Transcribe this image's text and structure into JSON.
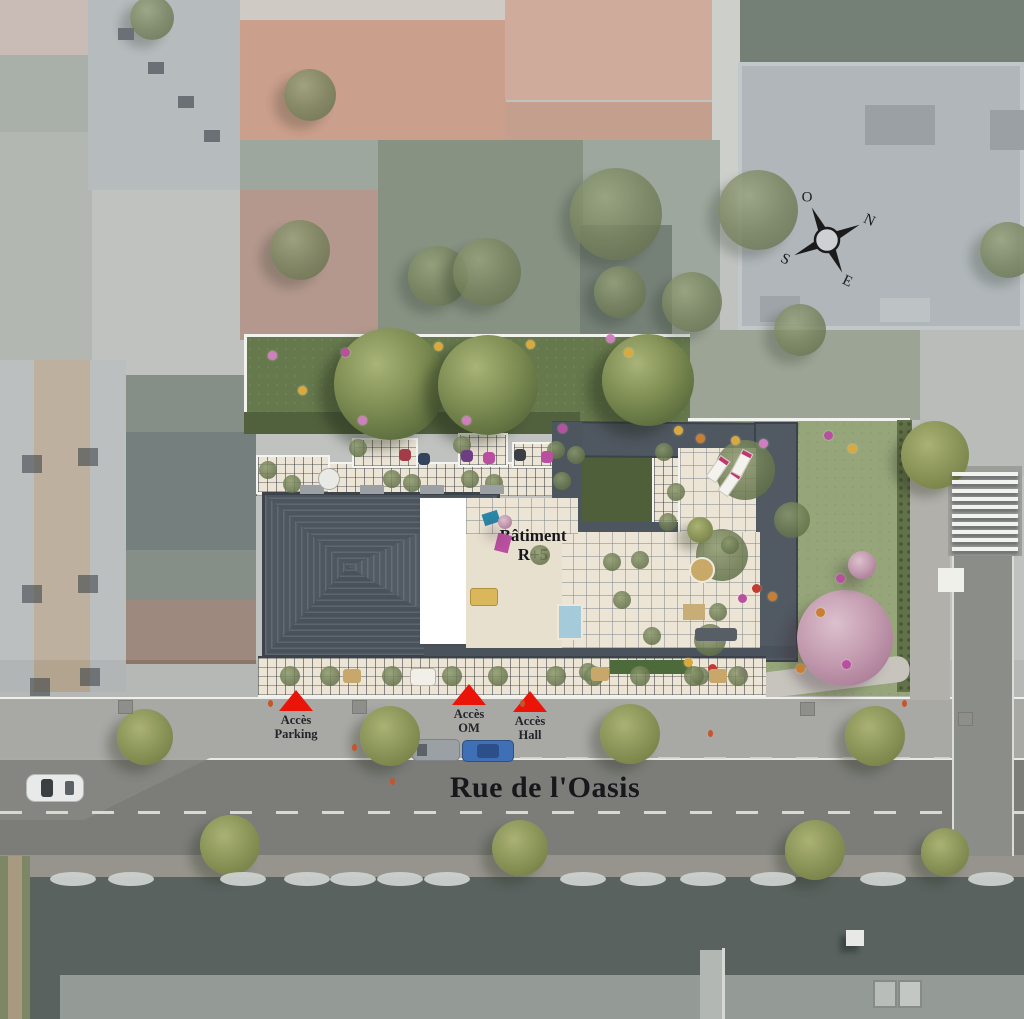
{
  "labels": {
    "building_line1": "Bâtiment",
    "building_line2": "R+5",
    "street_name": "Rue de l'Oasis"
  },
  "access_points": [
    {
      "line1": "Accès",
      "line2": "Parking"
    },
    {
      "line1": "Accès",
      "line2": "OM"
    },
    {
      "line1": "Accès",
      "line2": "Hall"
    }
  ],
  "compass": {
    "north": "N",
    "south": "S",
    "east": "E",
    "west": "O"
  },
  "colors": {
    "accent_red": "#ea1508",
    "lawn_green": "#66794c",
    "garden_green": "#96a67a",
    "roof_dark": "#4d555e",
    "terrace_cream": "#ece5d6",
    "road_gray": "#7c7d79",
    "aerial_wash": "#b5b8b4"
  }
}
